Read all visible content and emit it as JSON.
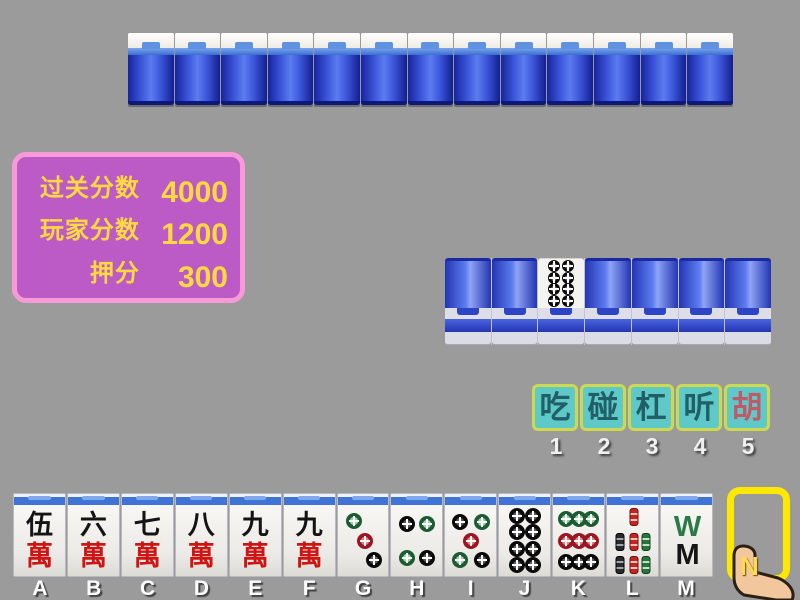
{
  "window": {
    "background_color": "#9b9b9b"
  },
  "score_panel": {
    "fill_color": "#bc5bc6",
    "border_color": "#f899d8",
    "text_color": "#ffd93f",
    "rows": [
      {
        "label": "过关分数",
        "value": "4000"
      },
      {
        "label": "玩家分数",
        "value": "1200"
      },
      {
        "label": "押分",
        "value": "300"
      }
    ]
  },
  "opponent_hand": {
    "tile_count": 13,
    "style": "face-down-standing",
    "back_color": "#3a54d8"
  },
  "discard_row": {
    "tiles": [
      {
        "face": "down"
      },
      {
        "face": "down"
      },
      {
        "face": "up",
        "name": "eight-dots",
        "dots": [
          {
            "x": 35,
            "y": 14,
            "c": "black"
          },
          {
            "x": 65,
            "y": 14,
            "c": "black"
          },
          {
            "x": 35,
            "y": 38,
            "c": "black"
          },
          {
            "x": 65,
            "y": 38,
            "c": "black"
          },
          {
            "x": 35,
            "y": 62,
            "c": "black"
          },
          {
            "x": 65,
            "y": 62,
            "c": "black"
          },
          {
            "x": 35,
            "y": 86,
            "c": "black"
          },
          {
            "x": 65,
            "y": 86,
            "c": "black"
          }
        ]
      },
      {
        "face": "down"
      },
      {
        "face": "down"
      },
      {
        "face": "down"
      },
      {
        "face": "down"
      }
    ]
  },
  "action_bar": {
    "fill_color": "#5fc9c9",
    "border_color": "#cdd94f",
    "buttons": [
      {
        "label": "吃",
        "number": "1",
        "text_color": "#215f66"
      },
      {
        "label": "碰",
        "number": "2",
        "text_color": "#215f66"
      },
      {
        "label": "杠",
        "number": "3",
        "text_color": "#215f66"
      },
      {
        "label": "听",
        "number": "4",
        "text_color": "#215f66"
      },
      {
        "label": "胡",
        "number": "5",
        "text_color": "#bf5a68"
      }
    ]
  },
  "player_hand": {
    "tiles": [
      {
        "label": "A",
        "name": "five-wan",
        "kind": "character",
        "top": "伍",
        "bottom": "萬"
      },
      {
        "label": "B",
        "name": "six-wan",
        "kind": "character",
        "top": "六",
        "bottom": "萬"
      },
      {
        "label": "C",
        "name": "seven-wan",
        "kind": "character",
        "top": "七",
        "bottom": "萬"
      },
      {
        "label": "D",
        "name": "eight-wan",
        "kind": "character",
        "top": "八",
        "bottom": "萬"
      },
      {
        "label": "E",
        "name": "nine-wan",
        "kind": "character",
        "top": "九",
        "bottom": "萬"
      },
      {
        "label": "F",
        "name": "nine-wan",
        "kind": "character",
        "top": "九",
        "bottom": "萬"
      },
      {
        "label": "G",
        "name": "three-dots",
        "kind": "dots",
        "dots": [
          {
            "x": 33,
            "y": 22,
            "c": "green"
          },
          {
            "x": 53,
            "y": 50,
            "c": "red"
          },
          {
            "x": 72,
            "y": 78,
            "c": "black"
          }
        ]
      },
      {
        "label": "H",
        "name": "four-dots",
        "kind": "dots",
        "dots": [
          {
            "x": 30,
            "y": 27,
            "c": "black"
          },
          {
            "x": 70,
            "y": 27,
            "c": "green"
          },
          {
            "x": 30,
            "y": 74,
            "c": "green"
          },
          {
            "x": 70,
            "y": 74,
            "c": "black"
          }
        ]
      },
      {
        "label": "I",
        "name": "five-dots",
        "kind": "dots",
        "dots": [
          {
            "x": 28,
            "y": 24,
            "c": "black"
          },
          {
            "x": 72,
            "y": 24,
            "c": "green"
          },
          {
            "x": 50,
            "y": 50,
            "c": "red"
          },
          {
            "x": 28,
            "y": 78,
            "c": "green"
          },
          {
            "x": 72,
            "y": 78,
            "c": "black"
          }
        ]
      },
      {
        "label": "J",
        "name": "eight-dots",
        "kind": "dots",
        "dots": [
          {
            "x": 34,
            "y": 15,
            "c": "black"
          },
          {
            "x": 66,
            "y": 15,
            "c": "black"
          },
          {
            "x": 34,
            "y": 38,
            "c": "black"
          },
          {
            "x": 66,
            "y": 38,
            "c": "black"
          },
          {
            "x": 34,
            "y": 62,
            "c": "black"
          },
          {
            "x": 66,
            "y": 62,
            "c": "black"
          },
          {
            "x": 34,
            "y": 85,
            "c": "black"
          },
          {
            "x": 66,
            "y": 85,
            "c": "black"
          }
        ]
      },
      {
        "label": "K",
        "name": "nine-dots",
        "kind": "dots",
        "dots": [
          {
            "x": 26,
            "y": 20,
            "c": "green"
          },
          {
            "x": 50,
            "y": 20,
            "c": "green"
          },
          {
            "x": 74,
            "y": 20,
            "c": "green"
          },
          {
            "x": 26,
            "y": 50,
            "c": "red"
          },
          {
            "x": 50,
            "y": 50,
            "c": "red"
          },
          {
            "x": 74,
            "y": 50,
            "c": "red"
          },
          {
            "x": 26,
            "y": 80,
            "c": "black"
          },
          {
            "x": 50,
            "y": 80,
            "c": "black"
          },
          {
            "x": 74,
            "y": 80,
            "c": "black"
          }
        ]
      },
      {
        "label": "L",
        "name": "seven-bamboo",
        "kind": "bamboo",
        "sticks": [
          {
            "x": 52,
            "y": 17,
            "c": "red"
          },
          {
            "x": 25,
            "y": 52,
            "c": "black"
          },
          {
            "x": 52,
            "y": 52,
            "c": "red"
          },
          {
            "x": 77,
            "y": 52,
            "c": "green"
          },
          {
            "x": 25,
            "y": 84,
            "c": "black"
          },
          {
            "x": 52,
            "y": 84,
            "c": "red"
          },
          {
            "x": 77,
            "y": 84,
            "c": "green"
          }
        ]
      },
      {
        "label": "M",
        "name": "eight-bamboo",
        "kind": "wm",
        "top_glyph": "W",
        "top_color": "#2c7a45",
        "bottom_glyph": "M",
        "bottom_color": "#151515"
      }
    ]
  },
  "draw_slot": {
    "label": "N",
    "outline_color": "#ffe800"
  },
  "cursor": {
    "name": "hand-pointer-cursor",
    "skin_color": "#f2c79e"
  }
}
